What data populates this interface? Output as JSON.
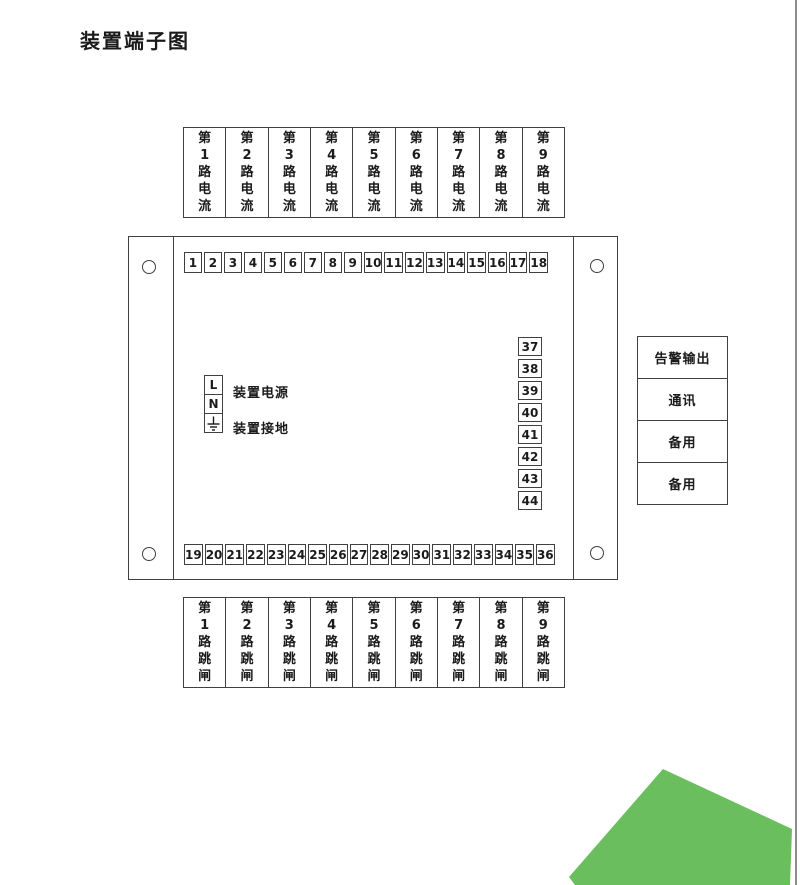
{
  "page": {
    "title": "装置端子图",
    "accent_green": "#6ABE5D",
    "line_color": "#404040"
  },
  "top_row": {
    "boxes": [
      "第1路电流",
      "第2路电流",
      "第3路电流",
      "第4路电流",
      "第5路电流",
      "第6路电流",
      "第7路电流",
      "第8路电流",
      "第9路电流"
    ]
  },
  "device": {
    "top_terminals": [
      "1",
      "2",
      "3",
      "4",
      "5",
      "6",
      "7",
      "8",
      "9",
      "10",
      "11",
      "12",
      "13",
      "14",
      "15",
      "16",
      "17",
      "18"
    ],
    "bottom_terminals": [
      "19",
      "20",
      "21",
      "22",
      "23",
      "24",
      "25",
      "26",
      "27",
      "28",
      "29",
      "30",
      "31",
      "32",
      "33",
      "34",
      "35",
      "36"
    ],
    "right_terminals": [
      "37",
      "38",
      "39",
      "40",
      "41",
      "42",
      "43",
      "44"
    ],
    "power": {
      "l_label": "L",
      "n_label": "N",
      "power_label": "装置电源",
      "ground_label": "装置接地"
    }
  },
  "right_panel": {
    "boxes": [
      "告警输出",
      "通讯",
      "备用",
      "备用"
    ]
  },
  "bottom_row": {
    "boxes": [
      "第1路跳闸",
      "第2路跳闸",
      "第3路跳闸",
      "第4路跳闸",
      "第5路跳闸",
      "第6路跳闸",
      "第7路跳闸",
      "第8路跳闸",
      "第9路跳闸"
    ]
  }
}
